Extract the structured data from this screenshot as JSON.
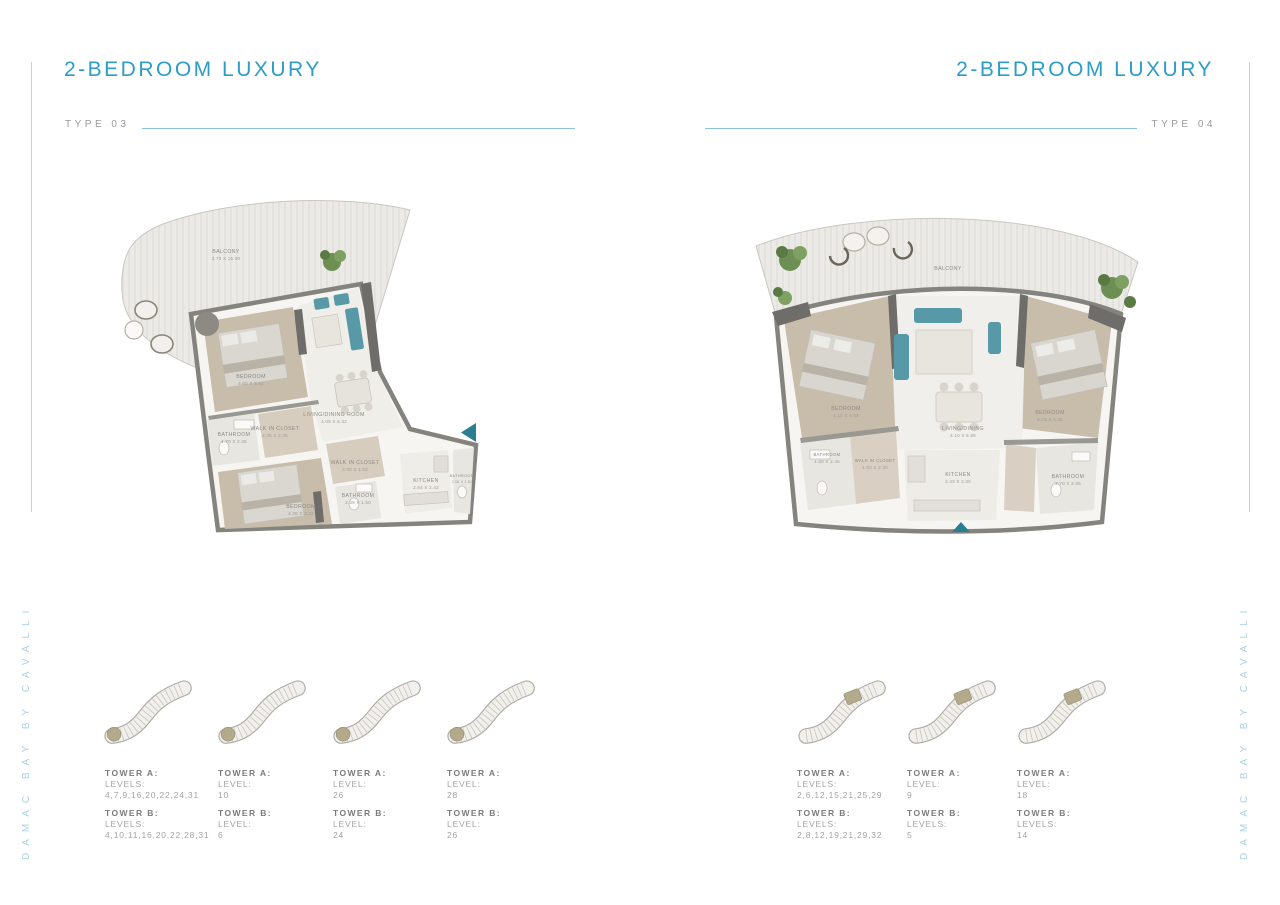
{
  "left_page": {
    "title": "2-BEDROOM LUXURY",
    "type_label": "TYPE 03",
    "side_text": "DAMAC BAY BY CAVALLI",
    "plan": {
      "rooms": {
        "balcony": {
          "name": "BALCONY",
          "dims": "3.70 X 15.00"
        },
        "bedroom1": {
          "name": "BEDROOM",
          "dims": "4.60 X 3.92"
        },
        "living": {
          "name": "LIVING/DINING ROOM",
          "dims": "4.09 X 6.32"
        },
        "wic1": {
          "name": "WALK IN CLOSET",
          "dims": "2.36 X 2.35"
        },
        "bath1": {
          "name": "BATHROOM",
          "dims": "1.70 X 2.35"
        },
        "bedroom2": {
          "name": "BEDROOM",
          "dims": "4.36 X 3.32"
        },
        "wic2": {
          "name": "WALK IN CLOSET",
          "dims": "3.00 X 1.62"
        },
        "bath2": {
          "name": "BATHROOM",
          "dims": "2.39 X 1.50"
        },
        "kitchen": {
          "name": "KITCHEN",
          "dims": "2.64 X 2.42"
        },
        "bath3": {
          "name": "BATHROOM",
          "dims": "2.06 X 1.52"
        }
      }
    },
    "towers": [
      {
        "a_title": "TOWER A:",
        "a_sub": "LEVELS:",
        "a_val": "4,7,9,16,20,22,24,31",
        "b_title": "TOWER B:",
        "b_sub": "LEVELS:",
        "b_val": "4,10,11,16,20,22,28,31"
      },
      {
        "a_title": "TOWER A:",
        "a_sub": "LEVEL:",
        "a_val": "10",
        "b_title": "TOWER B:",
        "b_sub": "LEVEL:",
        "b_val": "6"
      },
      {
        "a_title": "TOWER A:",
        "a_sub": "LEVEL:",
        "a_val": "26",
        "b_title": "TOWER B:",
        "b_sub": "LEVEL:",
        "b_val": "24"
      },
      {
        "a_title": "TOWER A:",
        "a_sub": "LEVEL:",
        "a_val": "28",
        "b_title": "TOWER B:",
        "b_sub": "LEVEL:",
        "b_val": "26"
      }
    ]
  },
  "right_page": {
    "title": "2-BEDROOM LUXURY",
    "type_label": "TYPE 04",
    "side_text": "DAMAC BAY BY CAVALLI",
    "plan": {
      "rooms": {
        "balcony": {
          "name": "BALCONY",
          "dims": ""
        },
        "bedroom_left": {
          "name": "BEDROOM",
          "dims": "4.10 X 4.04"
        },
        "living": {
          "name": "LIVING/DINING",
          "dims": "4.10 X 5.85"
        },
        "bedroom_right": {
          "name": "BEDROOM",
          "dims": "4.75 X 4.45"
        },
        "wic": {
          "name": "WALK IN CLOSET",
          "dims": "1.93 X 2.30"
        },
        "bath_left": {
          "name": "BATHROOM",
          "dims": "1.60 X 2.45"
        },
        "kitchen": {
          "name": "KITCHEN",
          "dims": "2.43 X 2.30"
        },
        "bath_right": {
          "name": "BATHROOM",
          "dims": "2.70 X 2.35"
        }
      }
    },
    "towers": [
      {
        "a_title": "TOWER A:",
        "a_sub": "LEVELS:",
        "a_val": "2,6,12,15,21,25,29",
        "b_title": "TOWER B:",
        "b_sub": "LEVELS:",
        "b_val": "2,8,12,19,21,29,32"
      },
      {
        "a_title": "TOWER A:",
        "a_sub": "LEVEL:",
        "a_val": "9",
        "b_title": "TOWER B:",
        "b_sub": "LEVELS:",
        "b_val": "5"
      },
      {
        "a_title": "TOWER A:",
        "a_sub": "LEVEL:",
        "a_val": "18",
        "b_title": "TOWER B:",
        "b_sub": "LEVELS:",
        "b_val": "14"
      }
    ]
  },
  "colors": {
    "accent_title": "#2d9dc8",
    "side_text": "#abd0e2",
    "rule_line": "#8fbfd9",
    "wall_gray": "#84837e",
    "wood_floor": "#c8bcab",
    "teal_accent": "#5899a8",
    "entry_arrow": "#2a7e91",
    "greenery": "#6d8f54",
    "highlight_unit_tan": "#b3aa8c"
  }
}
